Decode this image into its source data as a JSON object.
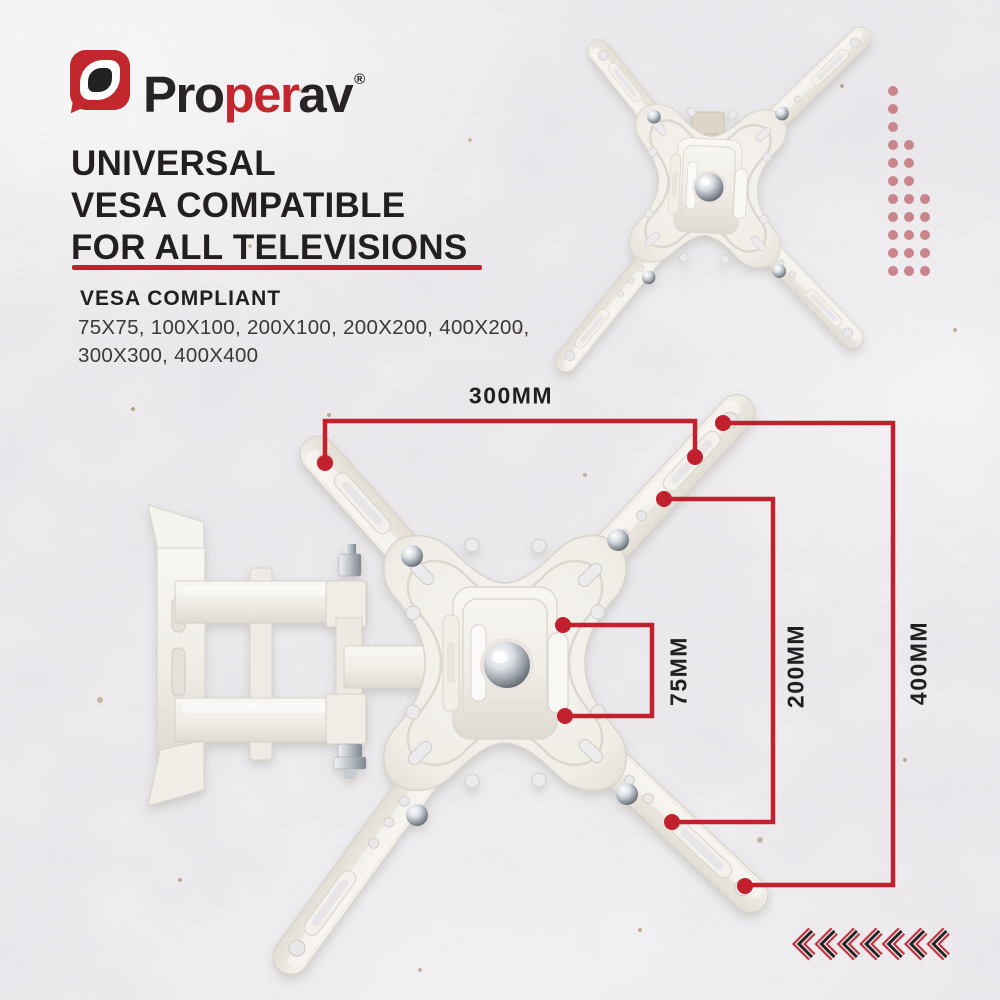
{
  "brand": {
    "pro": "Pro",
    "per": "per",
    "av": "av",
    "registered_mark": "®"
  },
  "headline": {
    "line1": "UNIVERSAL",
    "line2": "VESA COMPATIBLE",
    "line3": "FOR ALL TELEVISIONS"
  },
  "vesa_compliant": {
    "title": "VESA COMPLIANT",
    "sizes_line1": "75X75, 100X100, 200X100, 200X200, 400X200,",
    "sizes_line2": "300X300, 400X400"
  },
  "dimensions": {
    "width_top": "300MM",
    "vesa_small": "75MM",
    "vesa_mid": "200MM",
    "vesa_large": "400MM"
  },
  "decor": {
    "dot_rows": [
      1,
      1,
      1,
      2,
      2,
      2,
      3,
      3,
      3,
      3,
      3
    ],
    "chevron_count": 7
  },
  "colors": {
    "accent_red": "#c1202d",
    "logo_red": "#c1272d",
    "ink": "#231f20",
    "ink_soft": "#3c3839",
    "background": "#eae8ec",
    "dot_rose": "#c9858c",
    "chevron_red": "#c5343e",
    "chevron_ink": "#242424",
    "product_cream": "#f4f1ec"
  }
}
